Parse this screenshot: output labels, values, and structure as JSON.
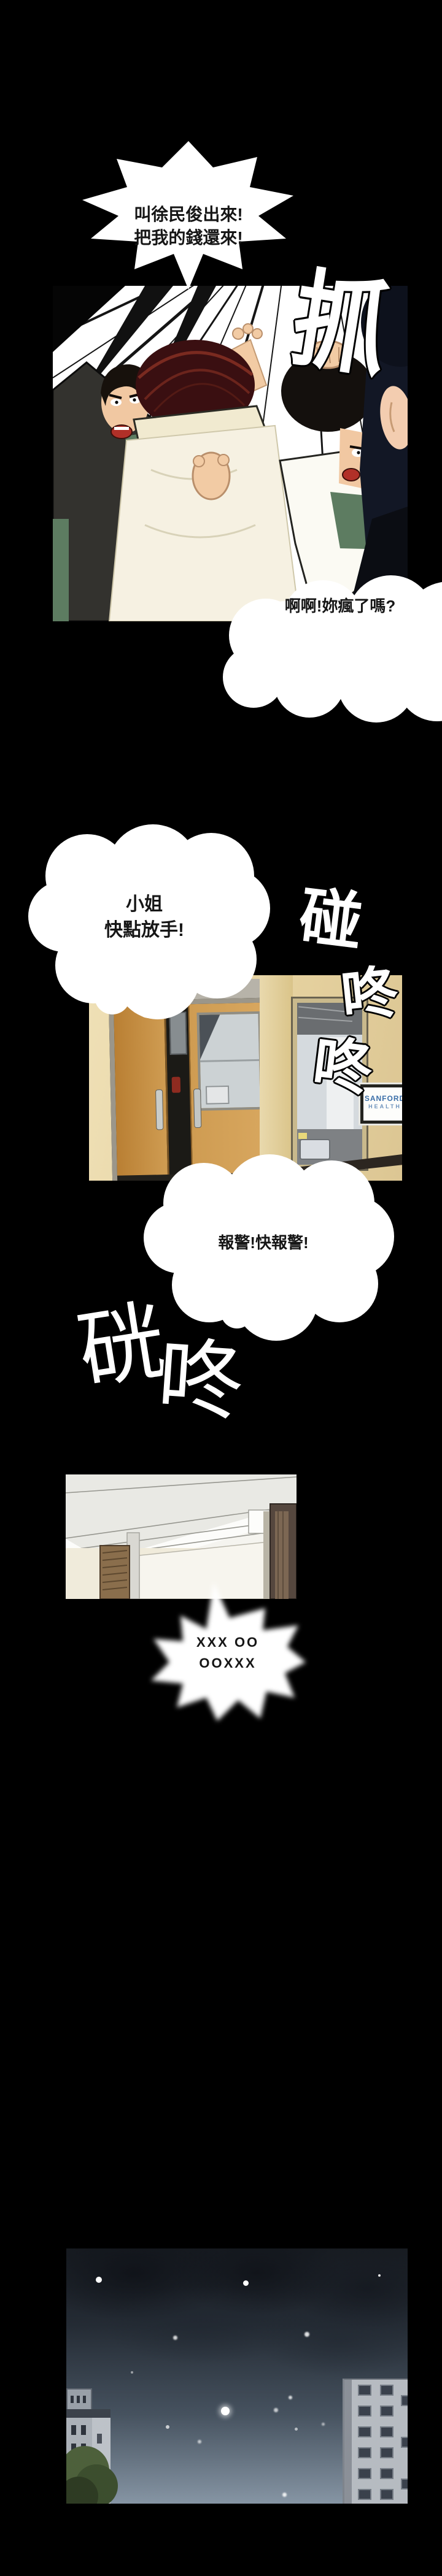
{
  "comic": {
    "bubble_demand": {
      "line1": "叫徐民俊出來!",
      "line2": "把我的錢還來!"
    },
    "bubble_crazy": {
      "text": "啊啊!妳瘋了嗎?"
    },
    "bubble_letgo": {
      "line1": "小姐",
      "line2": "快點放手!"
    },
    "bubble_police": {
      "text": "報警!快報警!"
    },
    "bubble_muffled": {
      "line1": "XXX OO",
      "line2": "OOXXX"
    },
    "sfx": {
      "grab": "抓",
      "bump": "碰",
      "knock_upper": "咚",
      "knock_lower": "咚",
      "thud_first": "硄",
      "thud_second": "咚"
    },
    "hallway_sign": {
      "line1": "SANFORD",
      "line2": "HEALTH"
    },
    "colors": {
      "page_bg": "#000000",
      "bubble_fill": "#ffffff",
      "bubble_text": "#161616",
      "sfx_fill": "#ffffff",
      "wood_door": "#c6913f",
      "wall_beige": "#e8d7ab",
      "suit_charcoal": "#33332f",
      "suit_navy": "#121725",
      "jacket_green": "#5d7c61",
      "hair_dark_red": "#4a1216",
      "coat_cream": "#f4efdc",
      "sign_text_blue": "#3a6ea8",
      "night_sky_top": "#171b21",
      "night_sky_bottom": "#8695a4"
    }
  }
}
